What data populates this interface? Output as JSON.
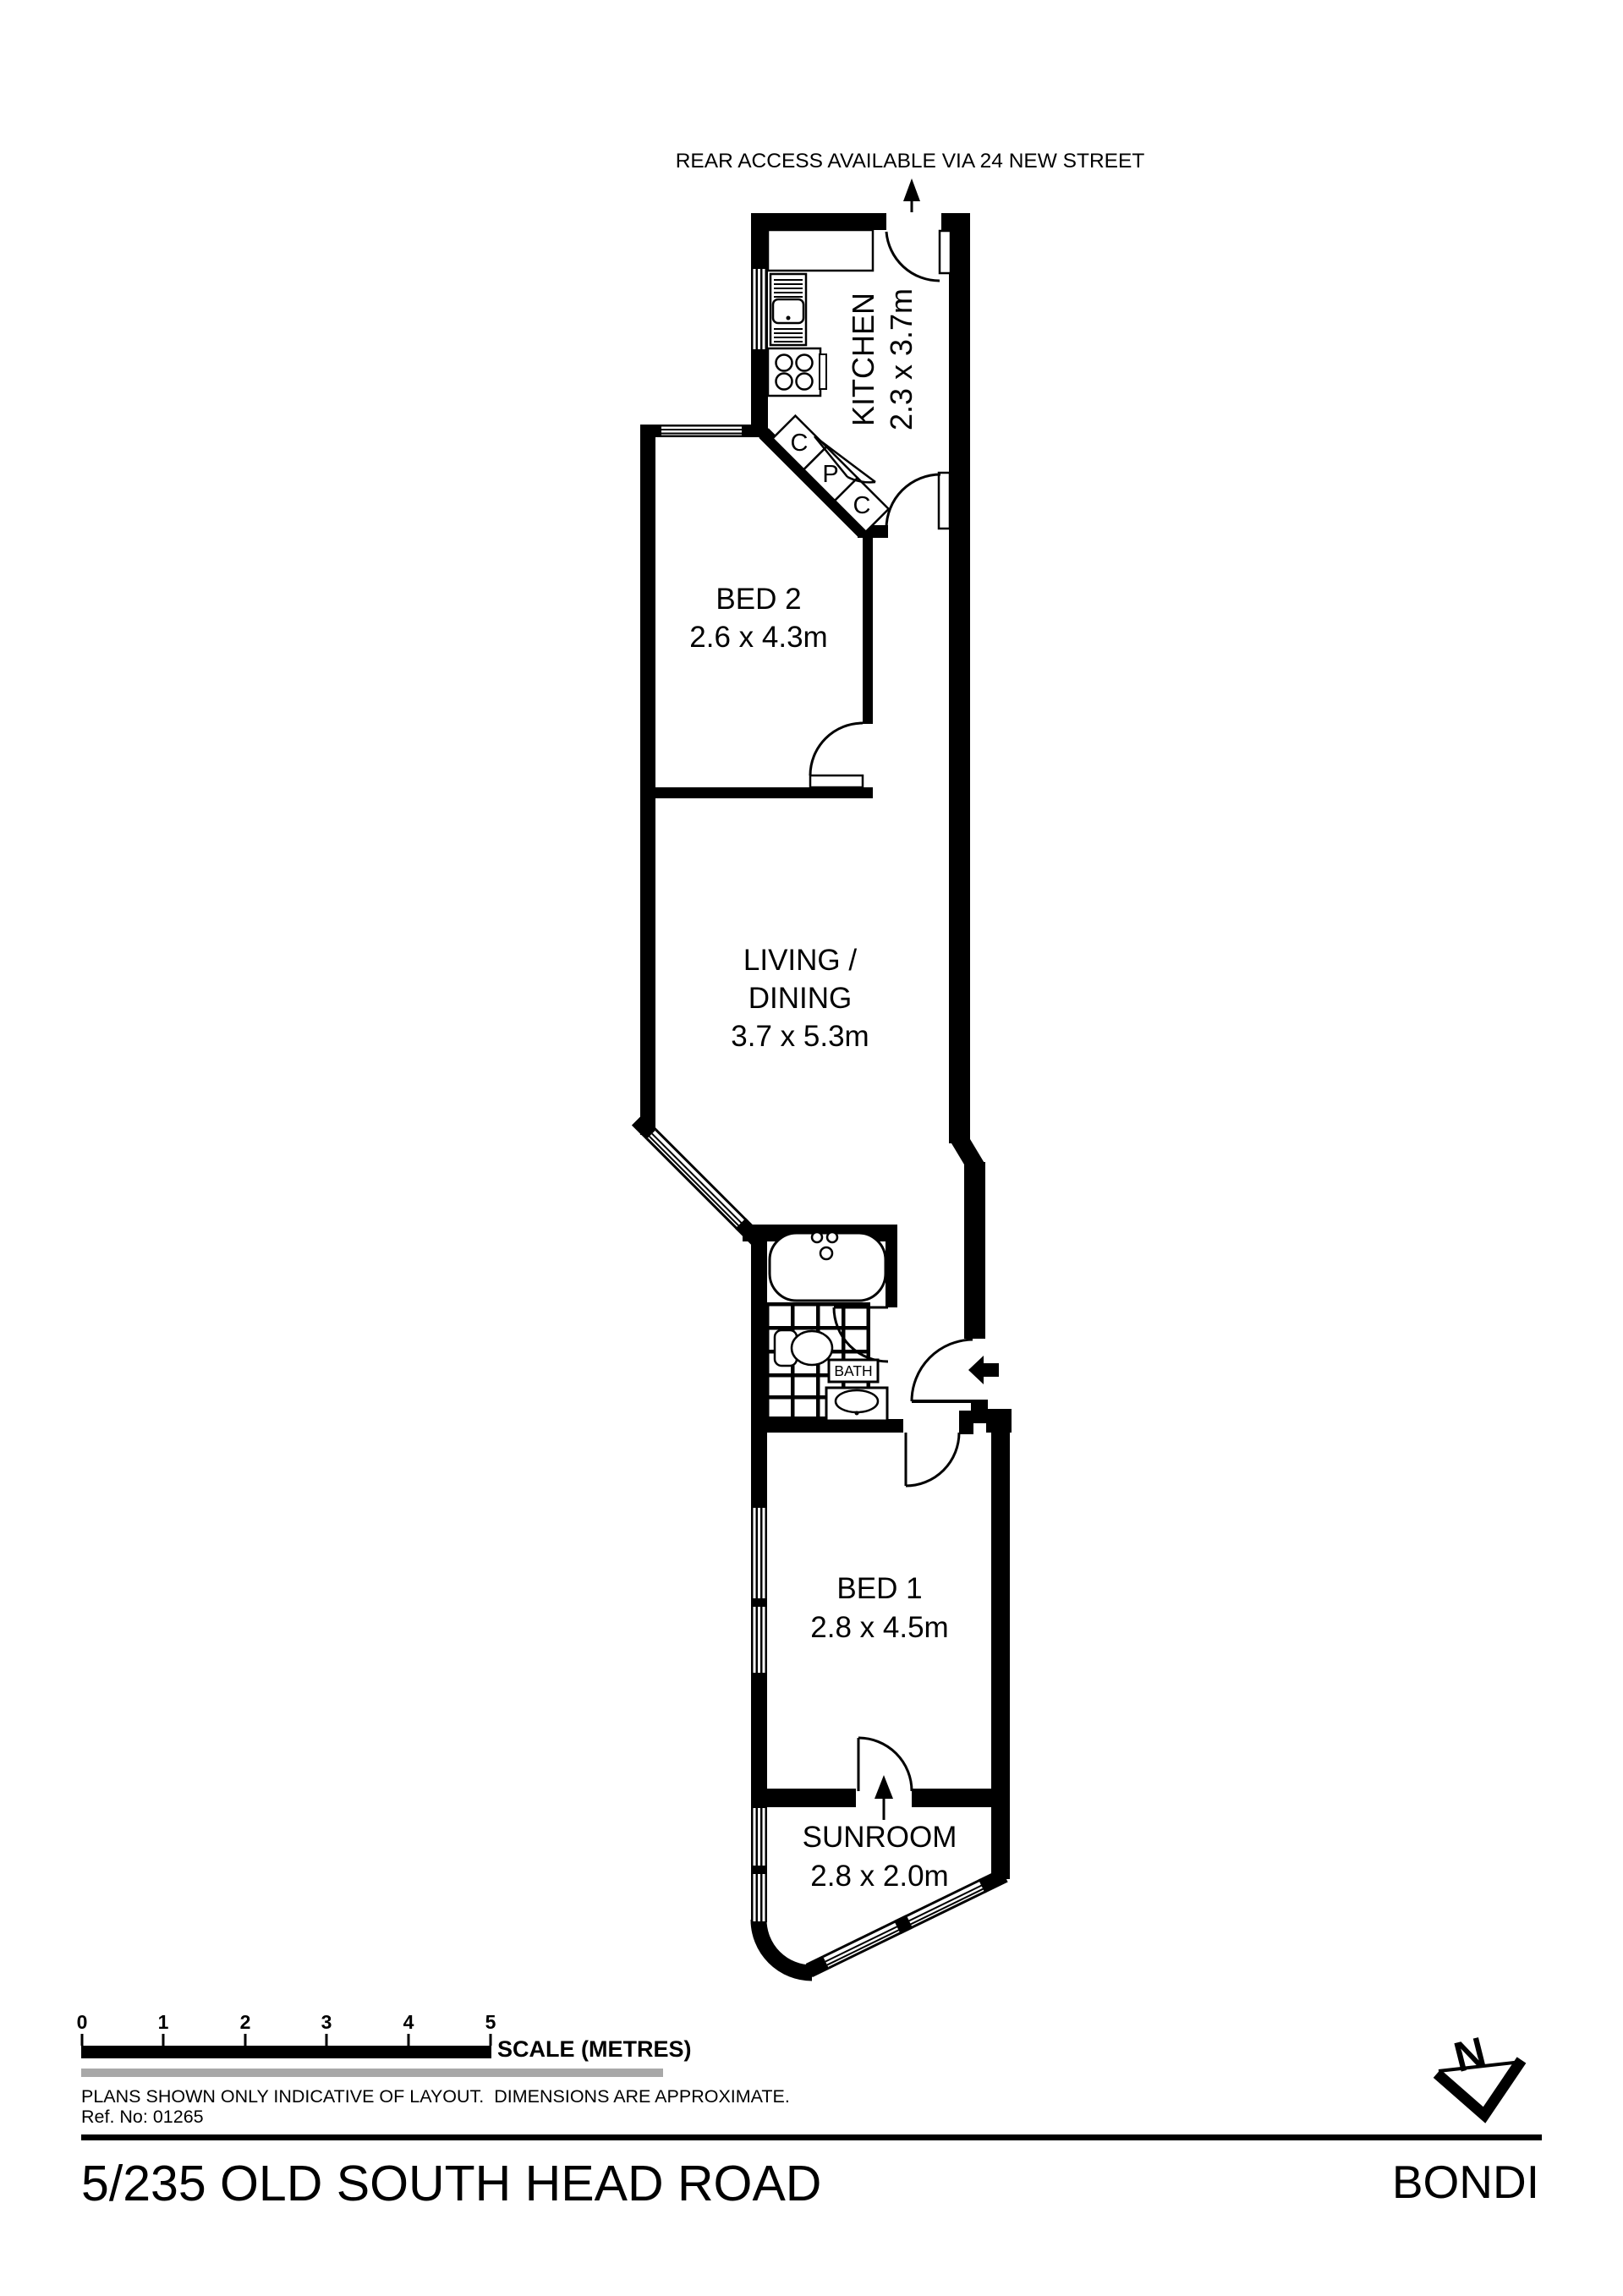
{
  "annotation": {
    "rear_access": "REAR ACCESS AVAILABLE VIA 24 NEW STREET"
  },
  "rooms": {
    "kitchen": {
      "name": "KITCHEN",
      "dims": "2.3 x 3.7m"
    },
    "bed2": {
      "name": "BED 2",
      "dims": "2.6 x 4.3m"
    },
    "living": {
      "line1": "LIVING /",
      "line2": "DINING",
      "dims": "3.7 x 5.3m"
    },
    "bed1": {
      "name": "BED 1",
      "dims": "2.8 x 4.5m"
    },
    "sunroom": {
      "name": "SUNROOM",
      "dims": "2.8 x 2.0m"
    },
    "bath": {
      "label": "BATH"
    }
  },
  "closets": {
    "c1": "C",
    "p": "P",
    "c2": "C"
  },
  "scale_bar": {
    "ticks": [
      "0",
      "1",
      "2",
      "3",
      "4",
      "5"
    ],
    "label": "SCALE (METRES)"
  },
  "notes": {
    "disclaimer": "PLANS SHOWN ONLY INDICATIVE OF LAYOUT.  DIMENSIONS ARE APPROXIMATE.",
    "ref": "Ref. No: 01265"
  },
  "footer": {
    "address": "5/235 OLD SOUTH HEAD ROAD",
    "suburb": "BONDI"
  },
  "compass": {
    "label": "N"
  },
  "colors": {
    "ink": "#000000",
    "paper": "#ffffff",
    "gray_bar": "#a8a8a8"
  }
}
